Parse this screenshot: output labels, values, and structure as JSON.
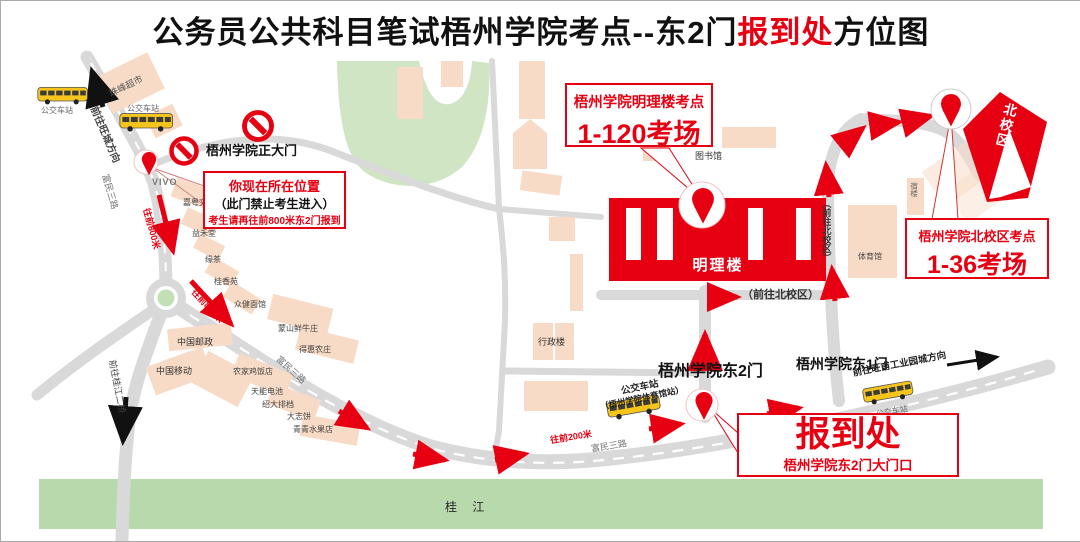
{
  "title": {
    "prefix": "公务员公共科目笔试梧州学院考点--东2门",
    "highlight": "报到处",
    "suffix": "方位图"
  },
  "colors": {
    "accent": "#e60012",
    "road": "#d9d9d9",
    "building": "#f8dbc6",
    "green_area": "#cfe5c3",
    "river": "#b7d9ab",
    "bus_yellow": "#f6c51c"
  },
  "callouts": {
    "current_location": {
      "line1": "你现在所在位置",
      "line2": "（此门禁止考生进入）",
      "line3": "考生请再往前800米东2门报到"
    },
    "mingli": {
      "line1": "梧州学院明理楼考点",
      "line2": "1-120考场"
    },
    "north": {
      "line1": "梧州学院北校区考点",
      "line2": "1-36考场"
    },
    "checkin": {
      "line1": "报到处",
      "line2": "梧州学院东2门大门口"
    }
  },
  "gates": {
    "main_gate": "梧州学院正大门",
    "east2": "梧州学院东2门",
    "east1": "梧州学院东1门"
  },
  "roads": {
    "to_wangcheng": "前往旺城方向",
    "fumin3_a": "富民三路",
    "fumin3_b": "富民三路",
    "fumin3_c": "富民三路",
    "to_guijiang_bridge": "前往桂江二桥",
    "to_north_campus_side": "（前往北校区）",
    "to_north_campus_bottom": "（前往北校区）",
    "to_wangfu": "前往旺甫工业园城方向",
    "forward800_a": "往前800米",
    "forward800_b": "往前800米",
    "forward200": "往前200米"
  },
  "bus_stops": {
    "a": "公交车站",
    "b": "公交车站",
    "gym_line1": "公交车站",
    "gym_line2": "（梧州学院体育馆站）",
    "d": "公交车站"
  },
  "places": {
    "zhufeng_market": "珠峰超市",
    "vivo": "VIVO",
    "stationery": "嘉粤文具",
    "milktea": "益禾堂",
    "tea": "缘茶",
    "guixiang": "桂香苑",
    "noodle": "众健面馆",
    "china_post": "中国邮政",
    "china_mobile": "中国移动",
    "beef_farm": "蒙山鲜牛庄",
    "dehui_farm": "得惠农庄",
    "farm_restaurant": "农家鸡饭店",
    "battery": "天能电池",
    "paidang": "绍大排档",
    "dazhi": "大志饼",
    "fruit_shop": "青青水果店",
    "admin_building": "行政楼",
    "library": "图书馆",
    "gym": "体育馆",
    "dorm": "宿楼"
  },
  "campus": {
    "mingli_building": "明理楼",
    "north_campus": "北校区"
  },
  "river": "桂 江"
}
